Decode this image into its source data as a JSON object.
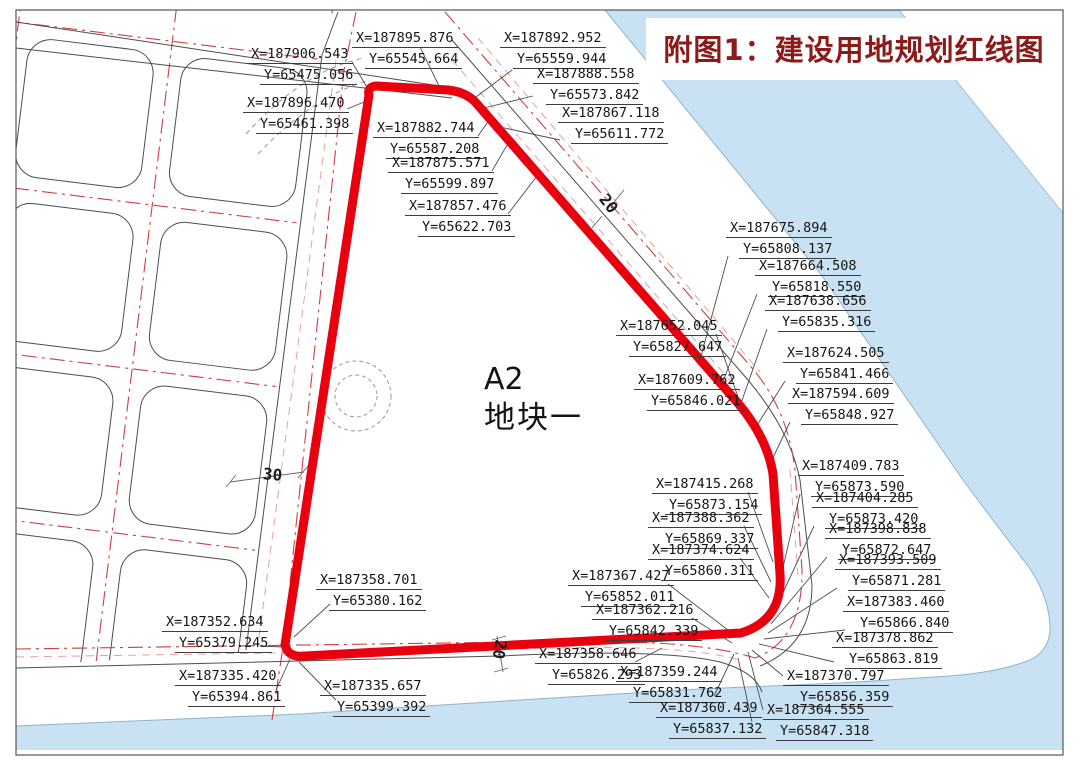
{
  "title": {
    "text": "附图1：建设用地规划红线图",
    "color": "#8b1a18"
  },
  "plot": {
    "code": "A2",
    "name": "地块一"
  },
  "map": {
    "red_line_color": "#e8000e",
    "water_color": "#c9e2f3",
    "centerline_color": "#cc4040",
    "road_widths": [
      {
        "text": "30",
        "px": 263,
        "py": 465,
        "rot": 5
      },
      {
        "text": "20",
        "px": 599,
        "py": 194,
        "rot": 52
      },
      {
        "text": "20",
        "px": 490,
        "py": 640,
        "rot": 100
      }
    ],
    "coordinate_labels": [
      {
        "x": "X=187906.543",
        "y": "Y=65475.056",
        "px": 247,
        "py": 46,
        "l": [
          352,
          62,
          371,
          94
        ]
      },
      {
        "x": "X=187896.470",
        "y": "Y=65461.398",
        "px": 243,
        "py": 95,
        "l": [
          347,
          109,
          369,
          100
        ]
      },
      {
        "x": "X=187895.876",
        "y": "Y=65545.664",
        "px": 352,
        "py": 30,
        "l": [
          420,
          47,
          440,
          88
        ]
      },
      {
        "x": "X=187892.952",
        "y": "Y=65559.944",
        "px": 500,
        "py": 30,
        "l": [
          512,
          70,
          472,
          100
        ]
      },
      {
        "x": "X=187888.558",
        "y": "Y=65573.842",
        "px": 533,
        "py": 66,
        "l": [
          533,
          96,
          484,
          108
        ]
      },
      {
        "x": "X=187867.118",
        "y": "Y=65611.772",
        "px": 558,
        "py": 105,
        "l": [
          560,
          140,
          500,
          127
        ]
      },
      {
        "x": "X=187882.744",
        "y": "Y=65587.208",
        "px": 373,
        "py": 120,
        "l": [
          478,
          136,
          492,
          116
        ]
      },
      {
        "x": "X=187875.571",
        "y": "Y=65599.897",
        "px": 388,
        "py": 155,
        "l": [
          492,
          171,
          510,
          140
        ]
      },
      {
        "x": "X=187857.476",
        "y": "Y=65622.703",
        "px": 405,
        "py": 198,
        "l": [
          508,
          214,
          540,
          172
        ]
      },
      {
        "x": "X=187675.894",
        "y": "Y=65808.137",
        "px": 726,
        "py": 220,
        "l": [
          728,
          256,
          700,
          360
        ]
      },
      {
        "x": "X=187664.508",
        "y": "Y=65818.550",
        "px": 755,
        "py": 258,
        "l": [
          757,
          294,
          722,
          384
        ]
      },
      {
        "x": "X=187638.656",
        "y": "Y=65835.316",
        "px": 765,
        "py": 293,
        "l": [
          767,
          329,
          740,
          406
        ]
      },
      {
        "x": "X=187652.045",
        "y": "Y=65827.647",
        "px": 616,
        "py": 318,
        "l": [
          716,
          334,
          744,
          414
        ]
      },
      {
        "x": "X=187624.505",
        "y": "Y=65841.466",
        "px": 783,
        "py": 345,
        "l": [
          785,
          381,
          754,
          430
        ]
      },
      {
        "x": "X=187609.762",
        "y": "Y=65846.021",
        "px": 634,
        "py": 372,
        "l": [
          730,
          388,
          762,
          447
        ]
      },
      {
        "x": "X=187594.609",
        "y": "Y=65848.927",
        "px": 788,
        "py": 386,
        "l": [
          790,
          422,
          770,
          464
        ]
      },
      {
        "x": "X=187415.268",
        "y": "Y=65873.154",
        "px": 652,
        "py": 476,
        "l": [
          748,
          492,
          773,
          562
        ]
      },
      {
        "x": "X=187388.362",
        "y": "Y=65869.337",
        "px": 648,
        "py": 510,
        "l": [
          744,
          526,
          771,
          582
        ]
      },
      {
        "x": "X=187374.624",
        "y": "Y=65860.311",
        "px": 648,
        "py": 542,
        "l": [
          740,
          558,
          769,
          598
        ]
      },
      {
        "x": "X=187409.783",
        "y": "Y=65873.590",
        "px": 798,
        "py": 458,
        "l": [
          800,
          494,
          775,
          602
        ]
      },
      {
        "x": "X=187404.285",
        "y": "Y=65873.420",
        "px": 812,
        "py": 490,
        "l": [
          814,
          526,
          773,
          614
        ]
      },
      {
        "x": "X=187398.838",
        "y": "Y=65872.647",
        "px": 825,
        "py": 521,
        "l": [
          827,
          557,
          771,
          624
        ]
      },
      {
        "x": "X=187393.509",
        "y": "Y=65871.281",
        "px": 835,
        "py": 552,
        "l": [
          837,
          588,
          768,
          633
        ]
      },
      {
        "x": "X=187383.460",
        "y": "Y=65866.840",
        "px": 843,
        "py": 594,
        "l": [
          845,
          630,
          764,
          639
        ]
      },
      {
        "x": "X=187378.862",
        "y": "Y=65863.819",
        "px": 832,
        "py": 630,
        "l": [
          834,
          662,
          759,
          644
        ]
      },
      {
        "x": "X=187370.797",
        "y": "Y=65856.359",
        "px": 783,
        "py": 668,
        "l": [
          783,
          676,
          752,
          650
        ]
      },
      {
        "x": "X=187364.555",
        "y": "Y=65847.318",
        "px": 763,
        "py": 702,
        "l": [
          763,
          710,
          748,
          652
        ]
      },
      {
        "x": "X=187367.427",
        "y": "Y=65852.011",
        "px": 568,
        "py": 568,
        "l": [
          668,
          584,
          737,
          637
        ]
      },
      {
        "x": "X=187362.216",
        "y": "Y=65842.339",
        "px": 592,
        "py": 602,
        "l": [
          692,
          618,
          732,
          643
        ]
      },
      {
        "x": "X=187358.646",
        "y": "Y=65826.293",
        "px": 535,
        "py": 646,
        "l": [
          635,
          662,
          662,
          648
        ]
      },
      {
        "x": "X=187359.244",
        "y": "Y=65831.762",
        "px": 616,
        "py": 664,
        "l": [
          714,
          696,
          734,
          654
        ]
      },
      {
        "x": "X=187360.439",
        "y": "Y=65837.132",
        "px": 656,
        "py": 700,
        "l": [
          752,
          722,
          738,
          658
        ]
      },
      {
        "x": "X=187358.701",
        "y": "Y=65380.162",
        "px": 316,
        "py": 572,
        "l": [
          330,
          604,
          294,
          637
        ]
      },
      {
        "x": "X=187352.634",
        "y": "Y=65379.245",
        "px": 162,
        "py": 614,
        "l": [
          260,
          646,
          284,
          647
        ]
      },
      {
        "x": "X=187335.420",
        "y": "Y=65394.861",
        "px": 175,
        "py": 668,
        "l": [
          276,
          690,
          290,
          659
        ]
      },
      {
        "x": "X=187335.657",
        "y": "Y=65399.392",
        "px": 320,
        "py": 678,
        "l": [
          336,
          700,
          299,
          662
        ]
      }
    ]
  }
}
